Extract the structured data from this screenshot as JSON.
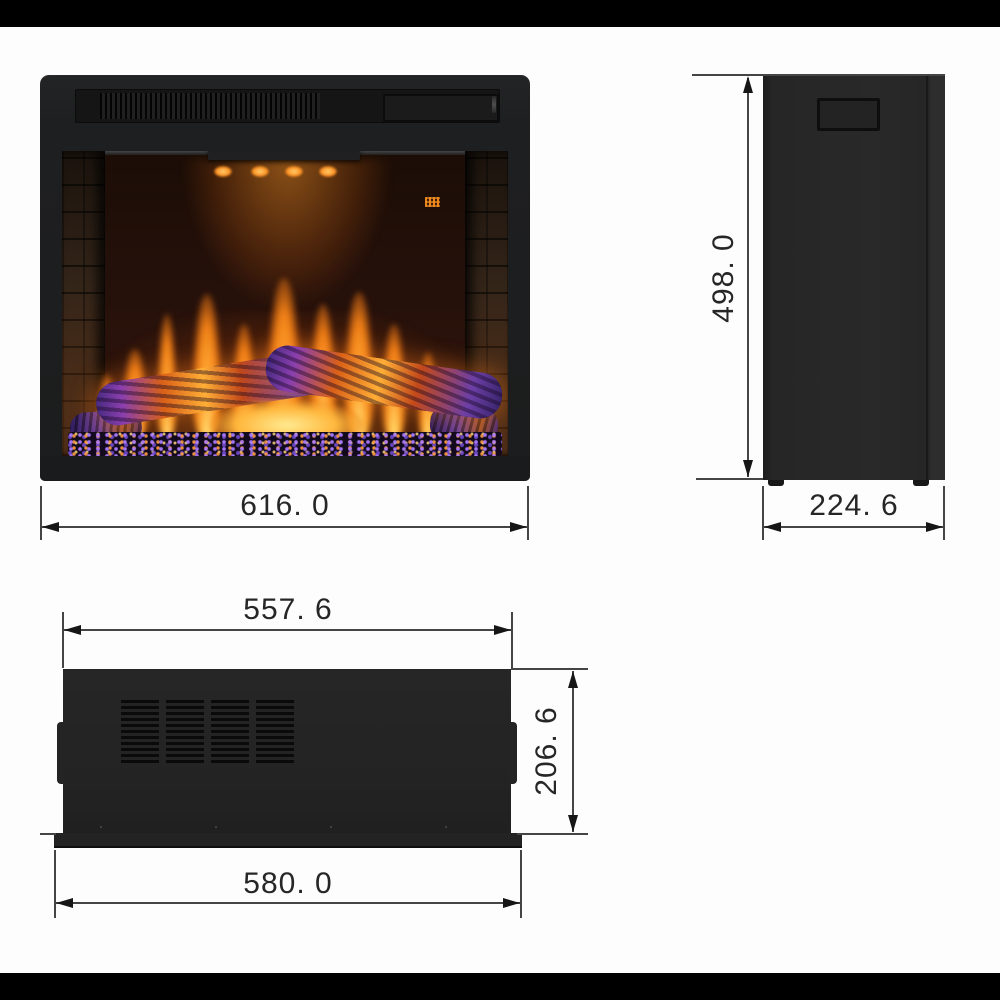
{
  "scene": {
    "background": "#fdfdfd",
    "letterbox_color": "#000000"
  },
  "drawing": {
    "product": "electric fireplace insert",
    "views": {
      "front": {
        "name": "front-view",
        "dimensions": {
          "overall_width": {
            "label": "616. 0",
            "value": 616.0
          }
        }
      },
      "side": {
        "name": "side-view",
        "dimensions": {
          "overall_height": {
            "label": "498. 0",
            "value": 498.0
          },
          "overall_depth": {
            "label": "224. 6",
            "value": 224.6
          }
        }
      },
      "bottom": {
        "name": "bottom-view",
        "dimensions": {
          "body_width": {
            "label": "557. 6",
            "value": 557.6
          },
          "body_depth": {
            "label": "206. 6",
            "value": 206.6
          },
          "flange_width": {
            "label": "580. 0",
            "value": 580.0
          }
        }
      }
    },
    "colors": {
      "dimension_line": "#454545",
      "dimension_text": "#262626",
      "cabinet_black": "#242424",
      "flame_orange": "#ff9a2e",
      "flame_yellow": "#ffd34e",
      "ember_purple": "#7a4fc8"
    }
  }
}
